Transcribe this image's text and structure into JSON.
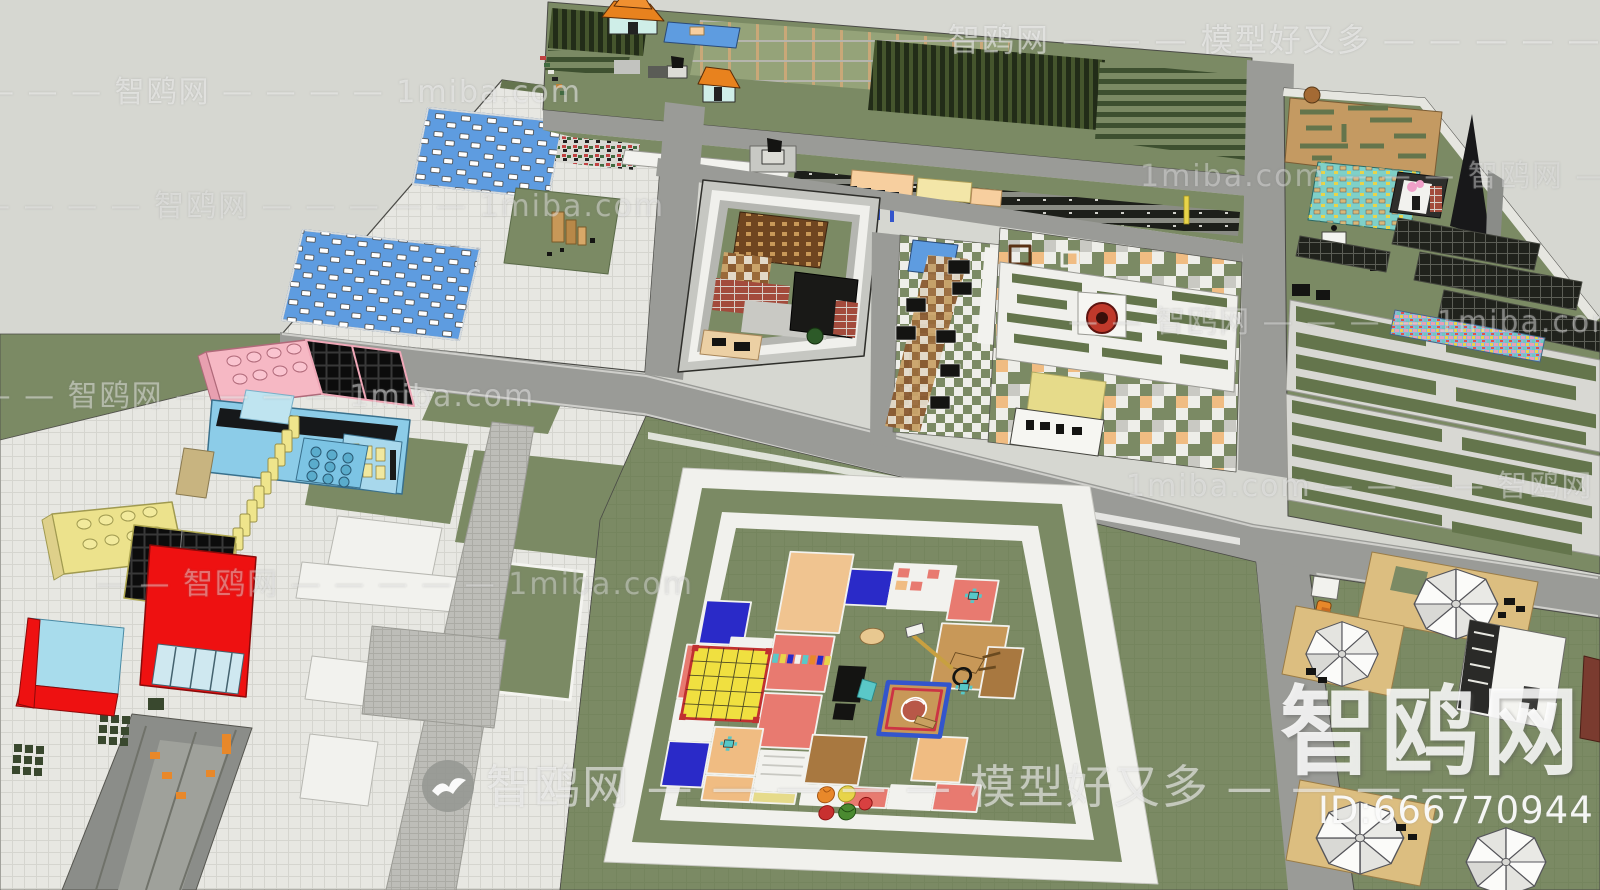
{
  "watermarks": {
    "brand": "智鸥网",
    "slogan": "模型好又多",
    "site": "1miba.com",
    "model_id": "ID:666770944",
    "big_text": "智鸥网",
    "rows": [
      {
        "text": "— — — 智鸥网 — — — — 1miba.com"
      },
      {
        "text": "智鸥网 — — — 模型好又多 — — — — —"
      },
      {
        "text": "— — — — 智鸥网 — — — — — 1miba.com"
      },
      {
        "text": "1miba.com — — — 智鸥网 — —"
      },
      {
        "text": "— — 智鸥网 — — — — 1miba.com"
      },
      {
        "text": "— — — — — 智鸥网 — — — — 1miba.com"
      },
      {
        "text": "1miba.com — — — — 智鸥网 — —"
      },
      {
        "text": "— — 智鸥网 — — — — — 1miba.com"
      },
      {
        "text": "智鸥网 — — — — — 模型好又多 — — — —"
      }
    ]
  },
  "palette": {
    "bg": "#d6d7d1",
    "lawn": "#7b8a64",
    "lawn_dark": "#64754c",
    "road": "#9a9b97",
    "road_dark": "#8b8d89",
    "plaza": "#e7e7e2",
    "white": "#f2f2ee",
    "pool": "#5e9ce0",
    "maze_tan": "#c49a62",
    "deck_tan": "#dcbe80",
    "lego_red": "#ee1111",
    "lego_pink": "#f6b8c4",
    "lego_blue": "#8ccce8",
    "lego_yellow": "#ece28c",
    "pool_wall": "#a8dcec",
    "tile_salmon": "#e87a70",
    "tile_blue": "#2a2ac8",
    "tile_orange": "#f0bc82",
    "tile_yellow": "#e6db8a",
    "tile_tan": "#f0c490",
    "canopy_yellow": "#f0e040",
    "fountain_red": "#c0392b",
    "teal": "#7fd0c8",
    "brown": "#8a5a2f"
  }
}
